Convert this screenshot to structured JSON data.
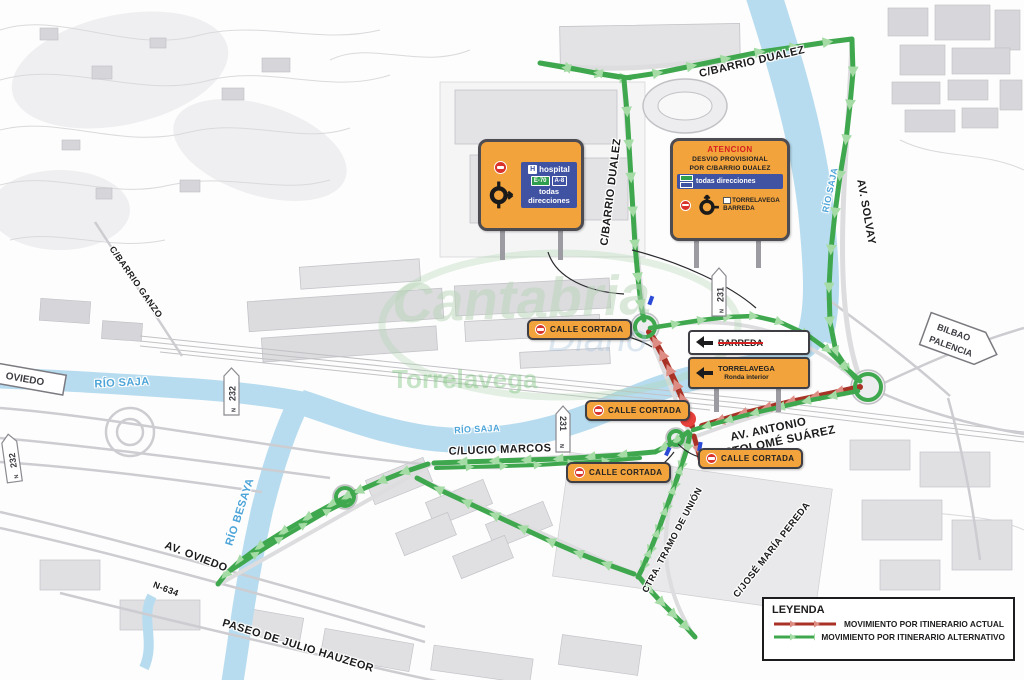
{
  "signs": {
    "hospital_panel": {
      "h_icon": "H",
      "hospital_label": "hospital",
      "badge_e70": "E-70",
      "badge_a8": "A-8",
      "todas_direcciones": "todas direcciones"
    },
    "atencion_panel": {
      "title": "ATENCION",
      "line1": "DESVIO PROVISIONAL",
      "line2": "POR C/BARRIO DUALEZ",
      "todas_direcciones": "todas direcciones",
      "dest1": "TORRELAVEGA",
      "dest2": "BARREDA"
    },
    "calle_cortada": "CALLE CORTADA",
    "barreda_sign": "BARREDA",
    "torrelavega_sign": {
      "line1": "TORRELAVEGA",
      "line2": "Ronda interior"
    },
    "oviedo_sign": "OVIEDO",
    "bilbao_sign": {
      "line1": "BILBAO",
      "line2": "PALENCIA"
    }
  },
  "street_labels": {
    "barrio_dualez_top": "C/BARRIO DUALEZ",
    "barrio_dualez_vert": "C/BARRIO DUALEZ",
    "av_solvay": "AV. SOLVAY",
    "barrio_ganzo": "C/BARRIO GANZO",
    "lucio_marcos": "C/LUCIO MARCOS",
    "av_antonio_1": "AV. ANTONIO",
    "av_antonio_2": "BARTOLOMÉ SUÁREZ",
    "ctra_tramo": "CTRA. TRAMO DE UNIÓN",
    "jose_maria_pereda": "C/JOSÉ MARÍA PEREDA",
    "av_oviedo": "AV. OVIEDO",
    "n634": "N-634",
    "paseo_julio": "PASEO DE JULIO HAUZEOR"
  },
  "river_labels": {
    "rio_saja_left": "RÍO SAJA",
    "rio_saja_mid": "RÍO SAJA",
    "rio_saja_right": "RÍO SAJA",
    "rio_besaya": "RÍO BESAYA"
  },
  "km_markers": {
    "m231": "231",
    "m232": "232",
    "road_symbol": "N"
  },
  "legend": {
    "title": "LEYENDA",
    "items": [
      {
        "label": "MOVIMIENTO POR ITINERARIO ACTUAL",
        "color": "#a93226"
      },
      {
        "label": "MOVIMIENTO POR ITINERARIO ALTERNATIVO",
        "color": "#3fa84e"
      }
    ]
  },
  "watermark": {
    "line1": "Cantabria",
    "line2": "Diario",
    "line3": "Torrelavega"
  },
  "colors": {
    "route_alternative": "#3fa84e",
    "route_actual": "#a93226",
    "sign_orange": "#f2a33c",
    "panel_blue": "#4053a3",
    "river_blue": "#b7dcef"
  }
}
